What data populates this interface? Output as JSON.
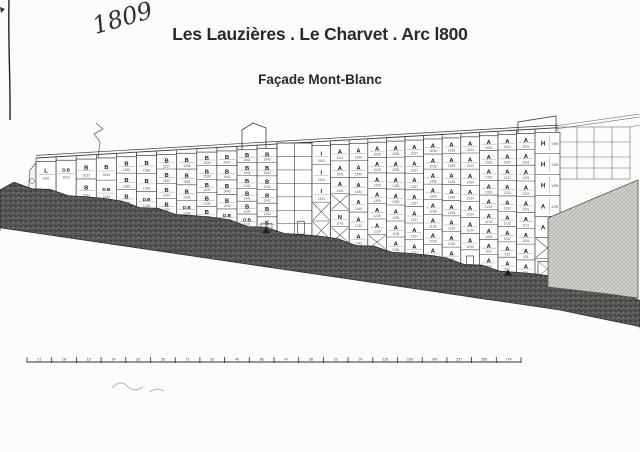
{
  "annotations": {
    "handwritten_number": "1809"
  },
  "title": "Les Lauzières . Le Charvet . Arc l800",
  "subtitle": "Façade Mont-Blanc",
  "drawing": {
    "left_wing": {
      "x": 36,
      "col_width": 20.1,
      "columns": [
        {
          "cells": [
            {
              "t": "L",
              "n": "1531"
            }
          ]
        },
        {
          "cells": [
            {
              "t": "D.B",
              "n": "1532"
            }
          ]
        },
        {
          "cells": [
            {
              "t": "B",
              "n": "1633"
            },
            {
              "t": "B",
              "n": "1533"
            }
          ]
        },
        {
          "cells": [
            {
              "t": "B",
              "n": "1634"
            },
            {
              "t": "D.B",
              "n": "1534"
            }
          ]
        },
        {
          "cells": [
            {
              "t": "B",
              "n": "1635"
            },
            {
              "t": "B",
              "n": "1535"
            },
            {
              "t": "B",
              "n": "1435"
            }
          ]
        },
        {
          "cells": [
            {
              "t": "B",
              "n": "1636"
            },
            {
              "t": "B",
              "n": "1536"
            },
            {
              "t": "D.B",
              "n": "1436"
            }
          ]
        },
        {
          "cells": [
            {
              "t": "B",
              "n": "1637"
            },
            {
              "t": "B",
              "n": "1537"
            },
            {
              "t": "B",
              "n": "1437"
            },
            {
              "t": "B",
              "n": "1337"
            }
          ]
        },
        {
          "cells": [
            {
              "t": "B",
              "n": "1638"
            },
            {
              "t": "B",
              "n": "1538"
            },
            {
              "t": "B",
              "n": "1438"
            },
            {
              "t": "D.B",
              "n": "1338"
            }
          ]
        },
        {
          "cells": [
            {
              "t": "B",
              "n": "1639"
            },
            {
              "t": "B",
              "n": "1539"
            },
            {
              "t": "B",
              "n": "1439"
            },
            {
              "t": "B",
              "n": "1339"
            },
            {
              "t": "B",
              "n": "1239"
            }
          ]
        },
        {
          "cells": [
            {
              "t": "B",
              "n": "1640"
            },
            {
              "t": "B",
              "n": "1540"
            },
            {
              "t": "B",
              "n": "1440"
            },
            {
              "t": "B",
              "n": "1340"
            },
            {
              "t": "D.B",
              "n": "1240"
            }
          ]
        },
        {
          "cells": [
            {
              "t": "B",
              "n": "1641"
            },
            {
              "t": "B",
              "n": "1541"
            },
            {
              "t": "B",
              "n": "1441"
            },
            {
              "t": "B",
              "n": "1341"
            },
            {
              "t": "B",
              "n": "1241"
            },
            {
              "t": "D.B",
              "n": "1141"
            }
          ]
        },
        {
          "cells": [
            {
              "t": "B",
              "n": "1642"
            },
            {
              "t": "B",
              "n": "1542"
            },
            {
              "t": "B",
              "n": "1442"
            },
            {
              "t": "B",
              "n": "1342"
            },
            {
              "t": "B",
              "n": "1242"
            },
            {
              "t": "K",
              "n": "1142"
            }
          ]
        }
      ]
    },
    "tower": {
      "x": 277,
      "width": 35,
      "rows": 7
    },
    "right_wing": {
      "x": 312,
      "col_width": 18.6,
      "columns": [
        {
          "cells": [
            {
              "t": "I",
              "n": "1643"
            },
            {
              "t": "I",
              "n": "1543"
            },
            {
              "t": "I",
              "n": "1443"
            },
            {
              "t": "X"
            },
            {
              "t": "X"
            }
          ]
        },
        {
          "cells": [
            {
              "t": "A",
              "n": "1641"
            },
            {
              "t": "A",
              "n": "1541"
            },
            {
              "t": "A",
              "n": "1441"
            },
            {
              "t": "X"
            },
            {
              "t": "N",
              "n": "1141"
            },
            {
              "t": "X"
            }
          ]
        },
        {
          "cells": [
            {
              "t": "A",
              "n": "1640"
            },
            {
              "t": "A",
              "n": "1540"
            },
            {
              "t": "A",
              "n": "1440"
            },
            {
              "t": "A",
              "n": "1340"
            },
            {
              "t": "A",
              "n": "1240"
            },
            {
              "t": "A",
              "n": "1140"
            }
          ]
        },
        {
          "cells": [
            {
              "t": "A",
              "n": "1639"
            },
            {
              "t": "A",
              "n": "1539"
            },
            {
              "t": "A",
              "n": "1439"
            },
            {
              "t": "A",
              "n": "1339"
            },
            {
              "t": "A",
              "n": "1239"
            },
            {
              "t": "A",
              "n": "1139"
            },
            {
              "t": "X"
            }
          ]
        },
        {
          "cells": [
            {
              "t": "A",
              "n": "1638"
            },
            {
              "t": "A",
              "n": "1538"
            },
            {
              "t": "A",
              "n": "1438"
            },
            {
              "t": "A",
              "n": "1338"
            },
            {
              "t": "A",
              "n": "1238"
            },
            {
              "t": "A",
              "n": "1138"
            },
            {
              "t": "A",
              "n": "1038"
            }
          ]
        },
        {
          "cells": [
            {
              "t": "A",
              "n": "1637"
            },
            {
              "t": "A",
              "n": "1537"
            },
            {
              "t": "A",
              "n": "1437"
            },
            {
              "t": "A",
              "n": "1337"
            },
            {
              "t": "A",
              "n": "1237"
            },
            {
              "t": "A",
              "n": "1137"
            },
            {
              "t": "A",
              "n": "1037"
            }
          ]
        },
        {
          "cells": [
            {
              "t": "A",
              "n": "1636"
            },
            {
              "t": "A",
              "n": "1536"
            },
            {
              "t": "A",
              "n": "1436"
            },
            {
              "t": "A",
              "n": "1336"
            },
            {
              "t": "A",
              "n": "1236"
            },
            {
              "t": "A",
              "n": "1136"
            },
            {
              "t": "A",
              "n": "1036"
            },
            {
              "t": "A",
              "n": "936"
            }
          ]
        },
        {
          "cells": [
            {
              "t": "A",
              "n": "1635"
            },
            {
              "t": "A",
              "n": "1535"
            },
            {
              "t": "A",
              "n": "1435"
            },
            {
              "t": "A",
              "n": "1335"
            },
            {
              "t": "A",
              "n": "1235"
            },
            {
              "t": "A",
              "n": "1135"
            },
            {
              "t": "A",
              "n": "1035"
            },
            {
              "t": "A",
              "n": "935"
            }
          ]
        },
        {
          "cells": [
            {
              "t": "A",
              "n": "1634"
            },
            {
              "t": "A",
              "n": "1534"
            },
            {
              "t": "A",
              "n": "1434"
            },
            {
              "t": "A",
              "n": "1334"
            },
            {
              "t": "A",
              "n": "1234"
            },
            {
              "t": "A",
              "n": "1134"
            },
            {
              "t": "A",
              "n": "1034"
            },
            {
              "t": "DOOR"
            }
          ]
        },
        {
          "cells": [
            {
              "t": "A",
              "n": "1633"
            },
            {
              "t": "A",
              "n": "1533"
            },
            {
              "t": "A",
              "n": "1433"
            },
            {
              "t": "A",
              "n": "1333"
            },
            {
              "t": "A",
              "n": "1233"
            },
            {
              "t": "A",
              "n": "1133"
            },
            {
              "t": "A",
              "n": "1033"
            },
            {
              "t": "A",
              "n": "933"
            },
            {
              "t": "A",
              "n": "833"
            }
          ]
        },
        {
          "cells": [
            {
              "t": "A",
              "n": "1632"
            },
            {
              "t": "A",
              "n": "1532"
            },
            {
              "t": "A",
              "n": "1432"
            },
            {
              "t": "A",
              "n": "1332"
            },
            {
              "t": "A",
              "n": "1232"
            },
            {
              "t": "A",
              "n": "1132"
            },
            {
              "t": "A",
              "n": "1032"
            },
            {
              "t": "A",
              "n": "932"
            },
            {
              "t": "A",
              "n": "832"
            }
          ]
        },
        {
          "cells": [
            {
              "t": "A",
              "n": "1631"
            },
            {
              "t": "A",
              "n": "1531"
            },
            {
              "t": "A",
              "n": "1431"
            },
            {
              "t": "A",
              "n": "1331"
            },
            {
              "t": "A",
              "n": "1231"
            },
            {
              "t": "A",
              "n": "1131"
            },
            {
              "t": "A",
              "n": "1031"
            },
            {
              "t": "A",
              "n": "931"
            },
            {
              "t": "A",
              "n": "831"
            }
          ]
        }
      ]
    },
    "h_column": {
      "x": 535,
      "width": 25,
      "cells": [
        {
          "t": "H",
          "n": "1555"
        },
        {
          "t": "H",
          "n": "1455"
        },
        {
          "t": "H",
          "n": "1355"
        },
        {
          "t": "A",
          "n": "1255"
        },
        {
          "t": "A",
          "n": "1155"
        },
        {
          "t": "X"
        },
        {
          "t": "WIN"
        }
      ]
    },
    "markers": [
      {
        "label": "cot 1650",
        "x": 266
      },
      {
        "label": "cot 1750",
        "x": 508
      }
    ],
    "scale_bar": {
      "x_start": 27,
      "x_end": 521,
      "y": 362,
      "labels": [
        "21",
        "18",
        "15",
        "14",
        "33",
        "55",
        "71",
        "20",
        "40",
        "86",
        "47",
        "58",
        "22",
        "24",
        "215",
        "206",
        "240",
        "237",
        "258",
        "774"
      ]
    }
  }
}
